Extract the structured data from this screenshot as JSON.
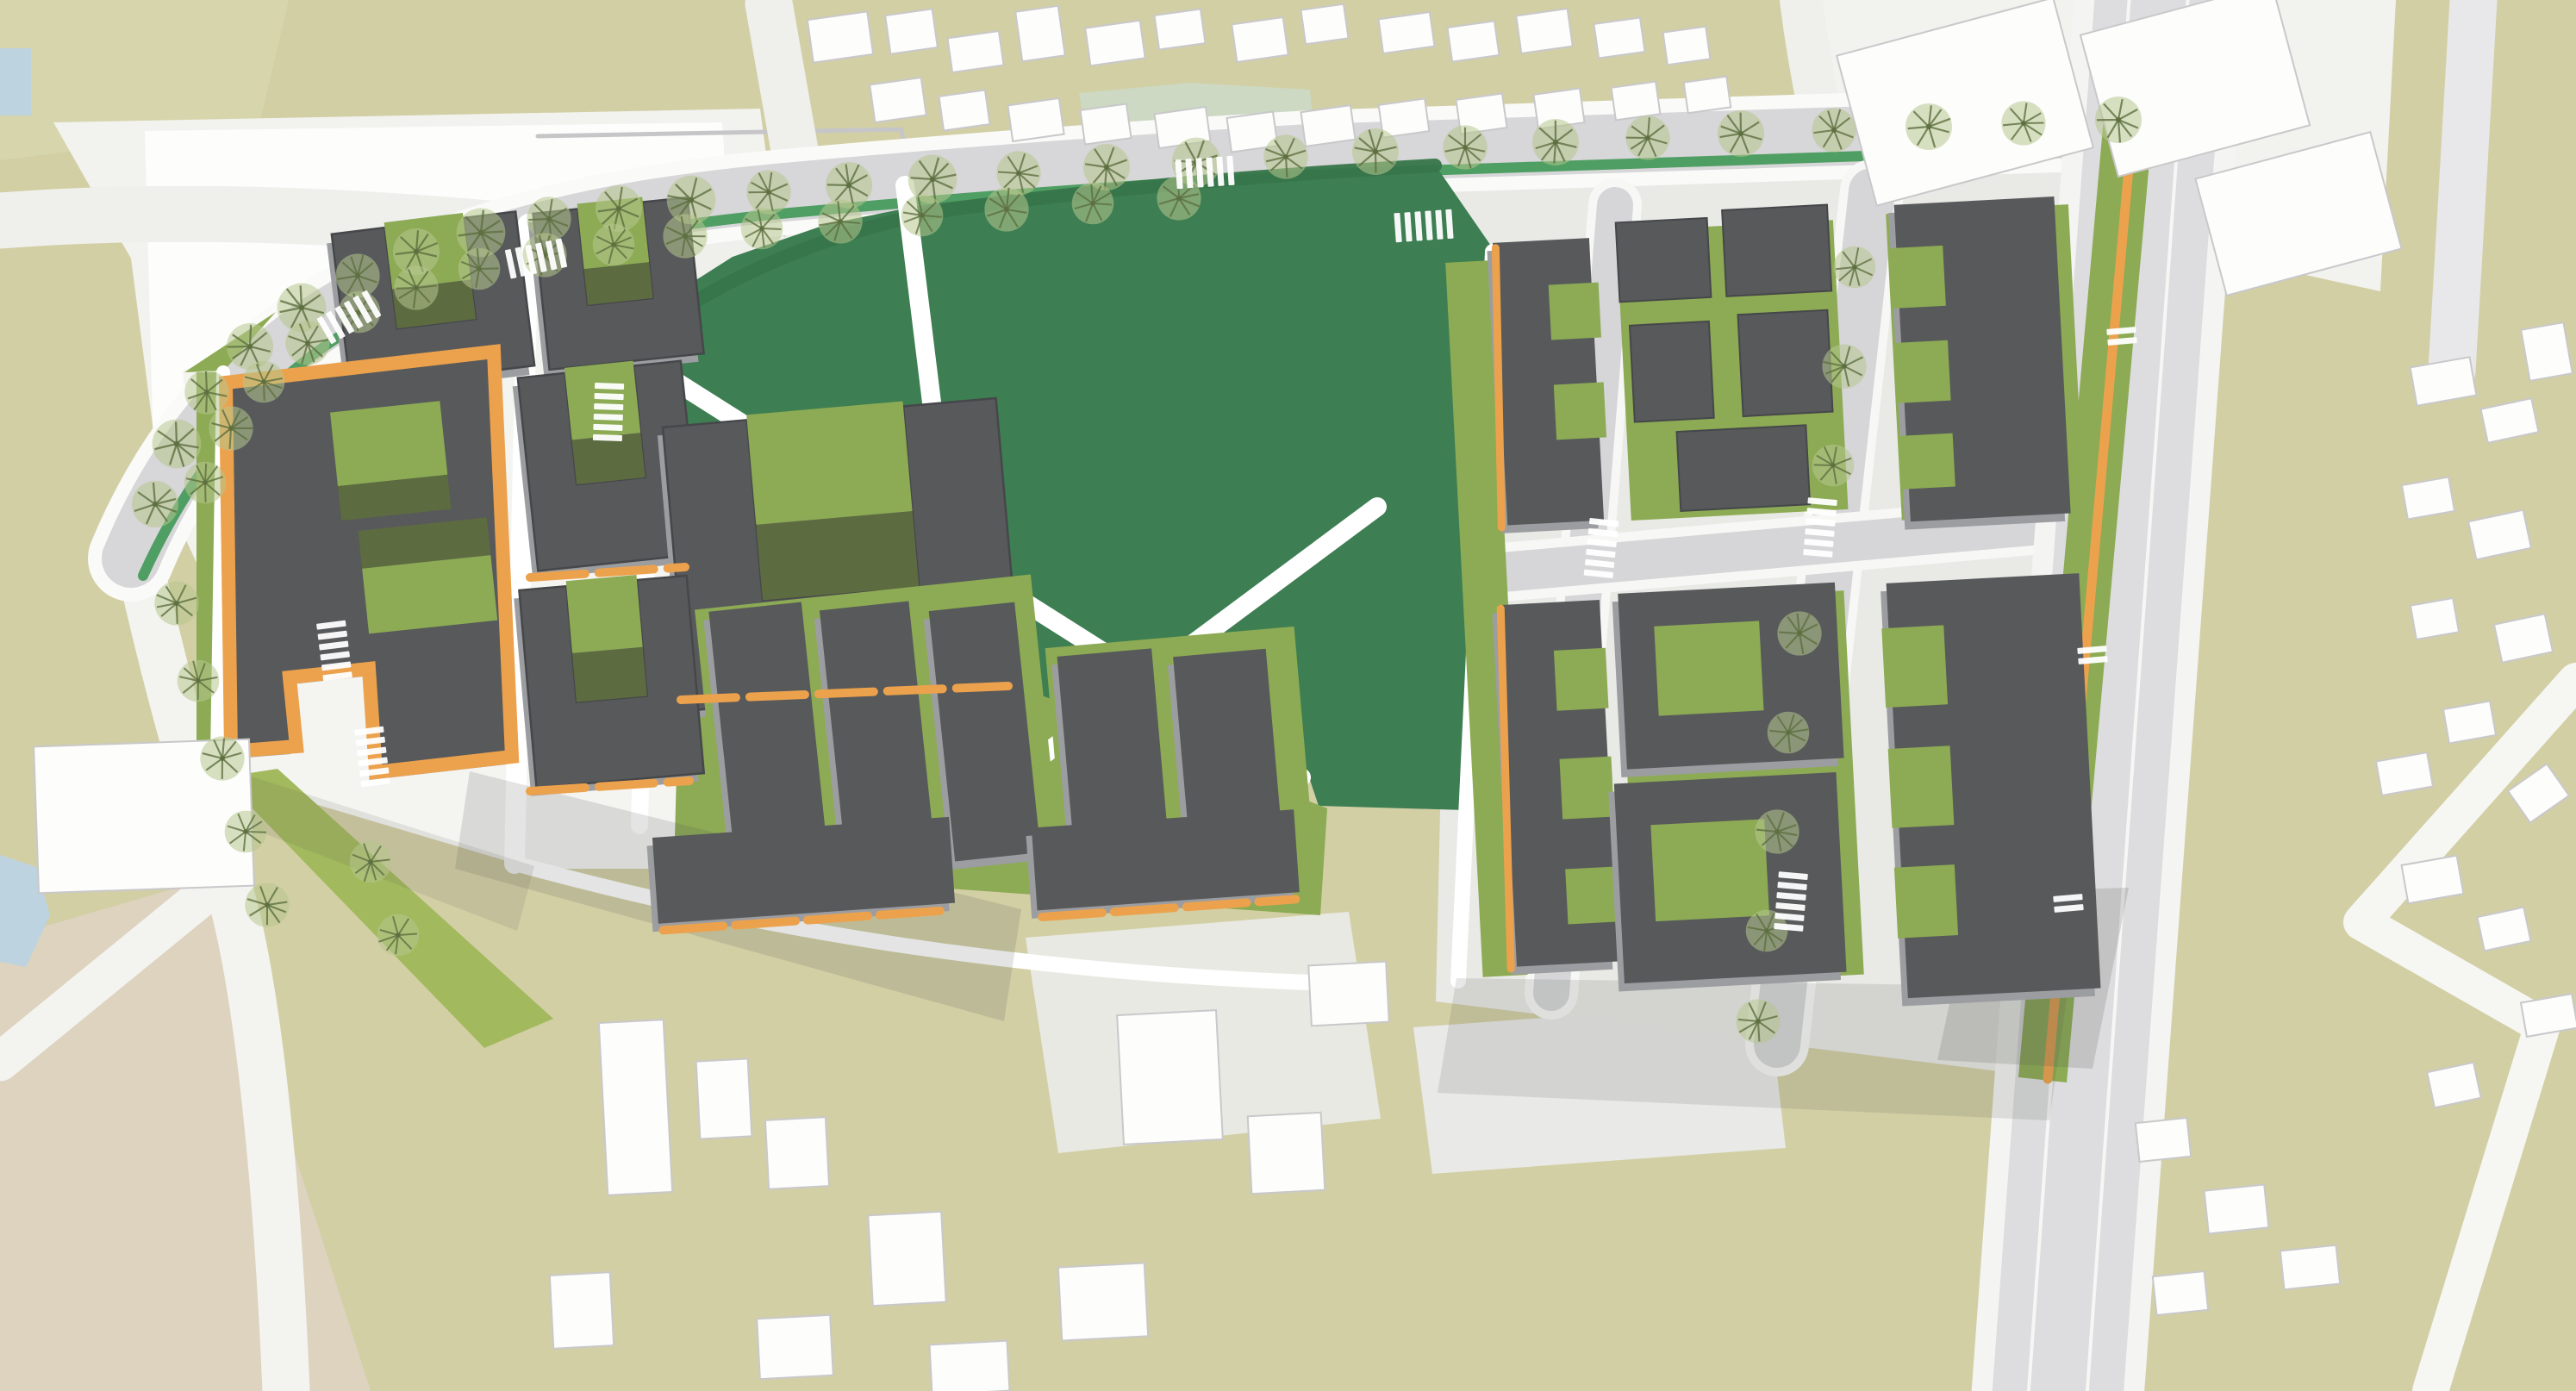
{
  "map": {
    "type": "urban-masterplan-site-plan",
    "palette": {
      "khaki": "#d2cfa5",
      "khakiPale": "#d6d5ac",
      "tan": "#ddd3bf",
      "sageA": "#c2d2bd",
      "sageB": "#cdd9c3",
      "water": "#bdd3e0",
      "roadWhite": "#fafaf8",
      "roadLight": "#efefec",
      "roadGray": "#d7d6d8",
      "avenue": "#dddcde",
      "groundLight": "#f2f2ef",
      "gridGround": "#e9e9e6",
      "padGray": "#e9e9e4",
      "park": "#3d7e52",
      "parkEdge": "#37764a",
      "verge": "#4f9e63",
      "olive": "#8cab54",
      "oliveDark": "#5d6b40",
      "oliveLight": "#a3b95e",
      "roofDark": "#58595b",
      "roofEdge": "#46474a",
      "facadeLight": "#9c9da0",
      "orange": "#eca24d",
      "white": "#fdfdfc",
      "ctxShadow": "#c9c8ca",
      "treeFill": "#b7c78e",
      "treeStroke": "#5e7040",
      "shadow": "#50554e"
    },
    "trees": [
      [
        180,
        585,
        1
      ],
      [
        205,
        515,
        1.05
      ],
      [
        240,
        455,
        0.95
      ],
      [
        290,
        402,
        1
      ],
      [
        350,
        357,
        1.05
      ],
      [
        415,
        320,
        0.95
      ],
      [
        483,
        292,
        1
      ],
      [
        558,
        270,
        1.05
      ],
      [
        637,
        254,
        0.95
      ],
      [
        718,
        242,
        1
      ],
      [
        802,
        232,
        1.05
      ],
      [
        892,
        223,
        0.95
      ],
      [
        985,
        215,
        1
      ],
      [
        1082,
        208,
        1.05
      ],
      [
        1182,
        201,
        0.95
      ],
      [
        1284,
        194,
        1
      ],
      [
        1388,
        188,
        1.05
      ],
      [
        1492,
        182,
        0.95
      ],
      [
        1596,
        176,
        1
      ],
      [
        238,
        560,
        0.9
      ],
      [
        268,
        497,
        0.95
      ],
      [
        306,
        443,
        0.9
      ],
      [
        357,
        398,
        0.95
      ],
      [
        417,
        362,
        0.9
      ],
      [
        483,
        334,
        0.95
      ],
      [
        556,
        312,
        0.9
      ],
      [
        632,
        296,
        0.95
      ],
      [
        712,
        284,
        0.9
      ],
      [
        795,
        274,
        0.95
      ],
      [
        884,
        265,
        0.9
      ],
      [
        975,
        257,
        0.95
      ],
      [
        1070,
        250,
        0.9
      ],
      [
        1168,
        243,
        0.95
      ],
      [
        1268,
        236,
        0.9
      ],
      [
        1368,
        230,
        0.95
      ],
      [
        1700,
        171,
        0.95
      ],
      [
        1805,
        165,
        1
      ],
      [
        1912,
        160,
        0.95
      ],
      [
        2020,
        155,
        1
      ],
      [
        2128,
        151,
        0.95
      ],
      [
        2238,
        147,
        1
      ],
      [
        2348,
        143,
        0.95
      ],
      [
        2458,
        139,
        1
      ],
      [
        2152,
        310,
        0.9
      ],
      [
        2140,
        425,
        0.95
      ],
      [
        2127,
        540,
        0.9
      ],
      [
        2088,
        735,
        0.95
      ],
      [
        2075,
        850,
        0.9
      ],
      [
        2062,
        965,
        0.95
      ],
      [
        2050,
        1080,
        0.9
      ],
      [
        2040,
        1185,
        0.95
      ],
      [
        205,
        700,
        0.95
      ],
      [
        230,
        790,
        0.9
      ],
      [
        258,
        880,
        0.95
      ],
      [
        285,
        965,
        0.9
      ],
      [
        310,
        1050,
        0.95
      ],
      [
        430,
        1000,
        0.9
      ],
      [
        462,
        1085,
        0.9
      ]
    ],
    "crosswalks": [
      [
        405,
        368,
        -30,
        6
      ],
      [
        622,
        300,
        -12,
        6
      ],
      [
        1652,
        262,
        -4,
        6
      ],
      [
        1398,
        200,
        -4,
        6
      ],
      [
        1858,
        636,
        96,
        6
      ],
      [
        2112,
        612,
        95,
        6
      ],
      [
        2078,
        1046,
        95,
        6
      ],
      [
        706,
        478,
        92,
        6
      ],
      [
        388,
        755,
        83,
        6
      ],
      [
        432,
        878,
        83,
        6
      ],
      [
        2462,
        390,
        85,
        2
      ],
      [
        2428,
        760,
        85,
        2
      ],
      [
        2400,
        1048,
        85,
        2
      ]
    ],
    "context_buildings": [
      [
        940,
        18,
        70,
        50,
        -8
      ],
      [
        1030,
        14,
        55,
        45,
        -8
      ],
      [
        1102,
        40,
        60,
        40,
        -8
      ],
      [
        1182,
        10,
        50,
        58,
        -8
      ],
      [
        1262,
        28,
        64,
        44,
        -8
      ],
      [
        1342,
        14,
        54,
        40,
        -8
      ],
      [
        1432,
        24,
        60,
        44,
        -8
      ],
      [
        1512,
        8,
        50,
        40,
        -8
      ],
      [
        1602,
        18,
        60,
        40,
        -8
      ],
      [
        1682,
        28,
        55,
        40,
        -8
      ],
      [
        1762,
        14,
        60,
        44,
        -8
      ],
      [
        1852,
        24,
        54,
        40,
        -8
      ],
      [
        1932,
        34,
        50,
        38,
        -8
      ],
      [
        1012,
        94,
        60,
        44,
        -8
      ],
      [
        1092,
        108,
        54,
        40,
        -8
      ],
      [
        1172,
        118,
        60,
        42,
        -8
      ],
      [
        1256,
        124,
        54,
        40,
        -8
      ],
      [
        1342,
        128,
        60,
        40,
        -8
      ],
      [
        1426,
        133,
        54,
        40,
        -8
      ],
      [
        1512,
        126,
        58,
        40,
        -8
      ],
      [
        1602,
        118,
        54,
        38,
        -8
      ],
      [
        1692,
        112,
        54,
        40,
        -8
      ],
      [
        1782,
        106,
        54,
        40,
        -8
      ],
      [
        1872,
        98,
        52,
        38,
        -8
      ],
      [
        1956,
        92,
        50,
        36,
        -8
      ],
      [
        2800,
        420,
        70,
        45,
        -10
      ],
      [
        2882,
        468,
        60,
        40,
        -12
      ],
      [
        2930,
        378,
        50,
        60,
        -10
      ],
      [
        2790,
        558,
        55,
        40,
        -10
      ],
      [
        2868,
        598,
        65,
        45,
        -12
      ],
      [
        2800,
        698,
        50,
        40,
        -10
      ],
      [
        2898,
        718,
        60,
        45,
        -12
      ],
      [
        2838,
        818,
        55,
        40,
        -10
      ],
      [
        2760,
        878,
        60,
        40,
        -10
      ],
      [
        2918,
        898,
        55,
        45,
        -35
      ],
      [
        2790,
        998,
        65,
        45,
        -10
      ],
      [
        2878,
        1058,
        55,
        40,
        -12
      ],
      [
        2928,
        1158,
        60,
        40,
        -10
      ],
      [
        2820,
        1238,
        55,
        42,
        -12
      ],
      [
        2480,
        1300,
        60,
        45,
        -6
      ],
      [
        2560,
        1378,
        70,
        50,
        -6
      ],
      [
        2500,
        1478,
        60,
        45,
        -6
      ],
      [
        2648,
        1448,
        65,
        45,
        -6
      ],
      [
        700,
        1185,
        75,
        200,
        -3
      ],
      [
        810,
        1230,
        60,
        90,
        -3
      ],
      [
        890,
        1298,
        70,
        80,
        -3
      ],
      [
        1010,
        1408,
        85,
        105,
        -3
      ],
      [
        1300,
        1175,
        115,
        150,
        -3
      ],
      [
        1450,
        1293,
        85,
        90,
        -3
      ],
      [
        1230,
        1468,
        100,
        85,
        -3
      ],
      [
        880,
        1528,
        85,
        70,
        -3
      ],
      [
        640,
        1478,
        70,
        85,
        -3
      ],
      [
        1520,
        1118,
        90,
        70,
        -3
      ],
      [
        1080,
        1558,
        90,
        58,
        -3
      ],
      [
        42,
        862,
        250,
        170,
        -2
      ],
      [
        2150,
        28,
        260,
        180,
        -15
      ],
      [
        2432,
        8,
        230,
        170,
        -15
      ],
      [
        2562,
        178,
        210,
        140,
        -15
      ]
    ]
  }
}
